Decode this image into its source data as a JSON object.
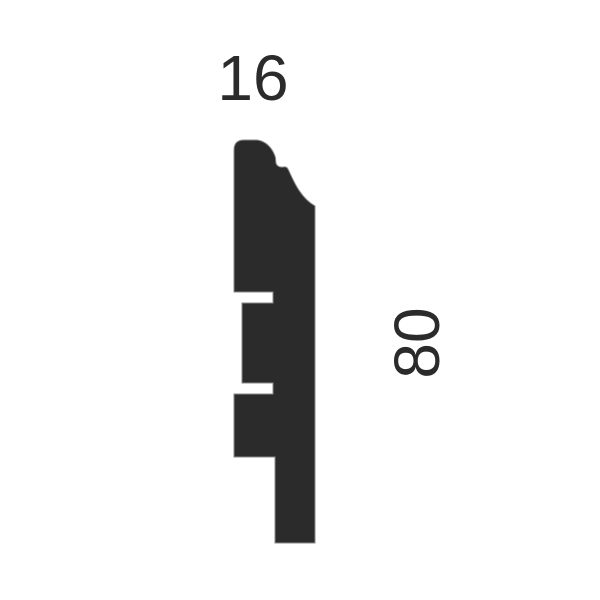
{
  "diagram": {
    "kind": "skirting-board-profile-cross-section",
    "background_color": "#ffffff",
    "shape_color": "#2b2b2b",
    "edge_color": "#8a8a8a",
    "dimensions": {
      "width_mm": "16",
      "height_mm": "80"
    }
  }
}
